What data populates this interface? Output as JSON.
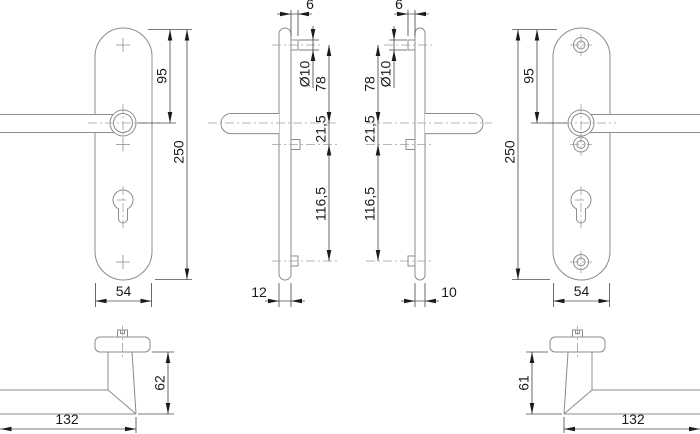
{
  "drawing": {
    "kind": "door-handle-dimension-drawing"
  },
  "views": {
    "left_plate_front": {
      "offset": "95",
      "height": "250",
      "width": "54"
    },
    "left_profile": {
      "pin_protrusion": "6",
      "pin_diameter": "Ø10",
      "pin_to_axis": "78",
      "axis_to_screw": "21,5",
      "screw_to_pin": "116,5",
      "thickness": "12"
    },
    "right_profile": {
      "pin_protrusion": "6",
      "pin_diameter": "Ø10",
      "pin_to_axis": "78",
      "axis_to_screw": "21,5",
      "screw_to_pin": "116,5",
      "thickness": "10"
    },
    "right_plate_front": {
      "offset": "95",
      "height": "250",
      "width": "54"
    },
    "left_lever_side": {
      "height": "62",
      "length": "132"
    },
    "right_lever_side": {
      "height": "61",
      "length": "132"
    }
  }
}
